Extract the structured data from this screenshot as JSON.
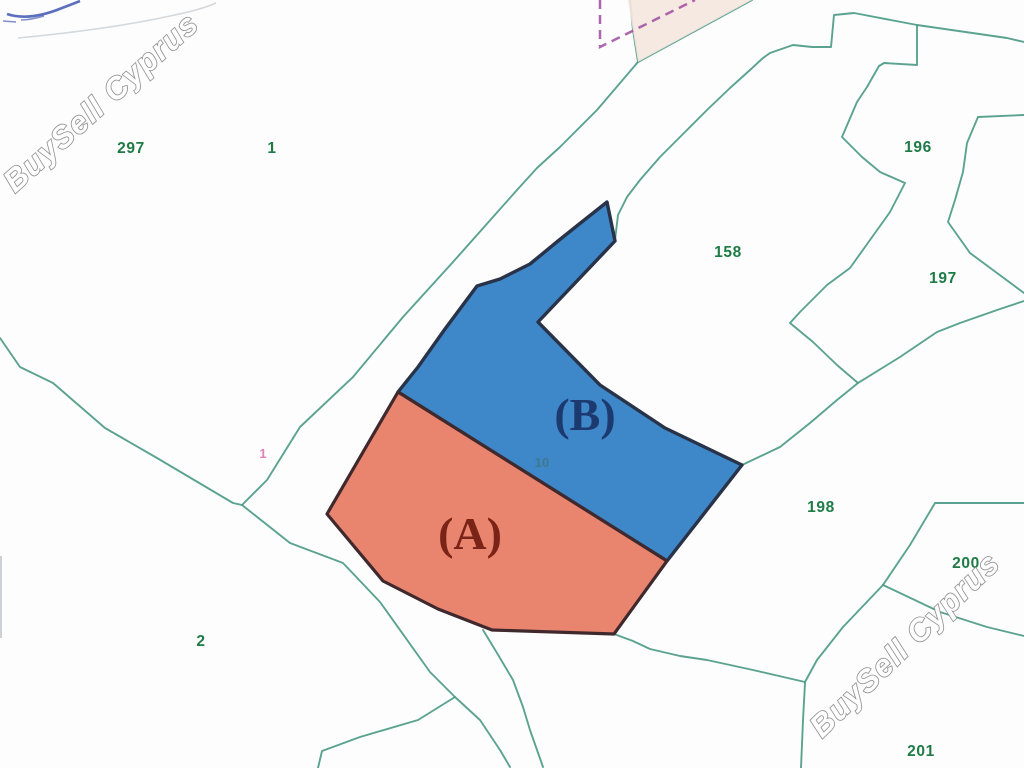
{
  "watermark": {
    "text": "BuySell Cyprus"
  },
  "map": {
    "plot_a_label": "(A)",
    "plot_b_label": "(B)",
    "boundary_label": "10",
    "pink_label": "1",
    "numbers": {
      "n297": "297",
      "n1": "1",
      "n196": "196",
      "n197": "197",
      "n158": "158",
      "n198": "198",
      "n200": "200",
      "n2": "2",
      "n201": "201"
    },
    "colors": {
      "plot_a_fill": "#e9846e",
      "plot_b_fill": "#3e87c9",
      "boundary_line": "#4d9b87",
      "number_green": "#1e7b46",
      "plot_a_text": "#7a2317",
      "plot_b_text": "#1d3a70",
      "beige_fill": "#f5e7df",
      "dashed_purple": "#a355a3",
      "pink_text": "#e080b8",
      "scribble_blue": "#4a5fb5",
      "label_10": "#3e7a8e"
    }
  }
}
